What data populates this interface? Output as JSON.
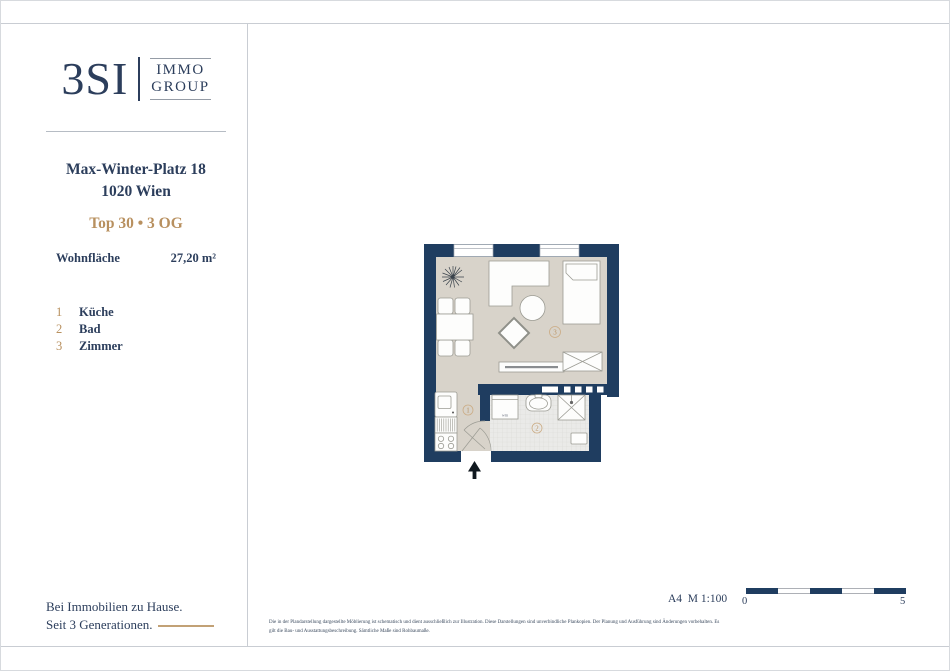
{
  "brand": {
    "logo_main": "3SI",
    "logo_word1": "IMMO",
    "logo_word2": "GROUP"
  },
  "property": {
    "address_line1": "Max-Winter-Platz 18",
    "address_line2": "1020 Wien",
    "unit_line": "Top 30 • 3 OG",
    "area_label": "Wohnfläche",
    "area_value": "27,20 m²"
  },
  "legend": {
    "items": [
      {
        "num": "1",
        "label": "Küche"
      },
      {
        "num": "2",
        "label": "Bad"
      },
      {
        "num": "3",
        "label": "Zimmer"
      }
    ]
  },
  "floor_plan": {
    "labels": {
      "kitchen": "1",
      "bath": "2",
      "room": "3"
    },
    "washing_machine": "wm"
  },
  "scale": {
    "note": "A4  M 1:100",
    "start": "0",
    "end": "5"
  },
  "footer": {
    "line1": "Bei Immobilien zu Hause.",
    "line2": "Seit 3 Generationen."
  },
  "disclaimer": {
    "line1": "Die in der Plandarstellung dargestellte Möblierung ist schematisch und dient ausschließlich zur Illustration. Diese Darstellungen sind unverbindliche Plankopien. Der Planung und Ausführung sind Änderungen vorbehalten. Es",
    "line2": "gilt die Bau- und Ausstattungsbeschreibung. Sämtliche Maße sind Rohbaumaße."
  },
  "colors": {
    "navy_text": "#2c3e5c",
    "wall_navy": "#1f3d60",
    "accent_tan": "#b8905f",
    "floor_beige": "#d8d3ca",
    "tile_grey": "#eaeae8"
  }
}
